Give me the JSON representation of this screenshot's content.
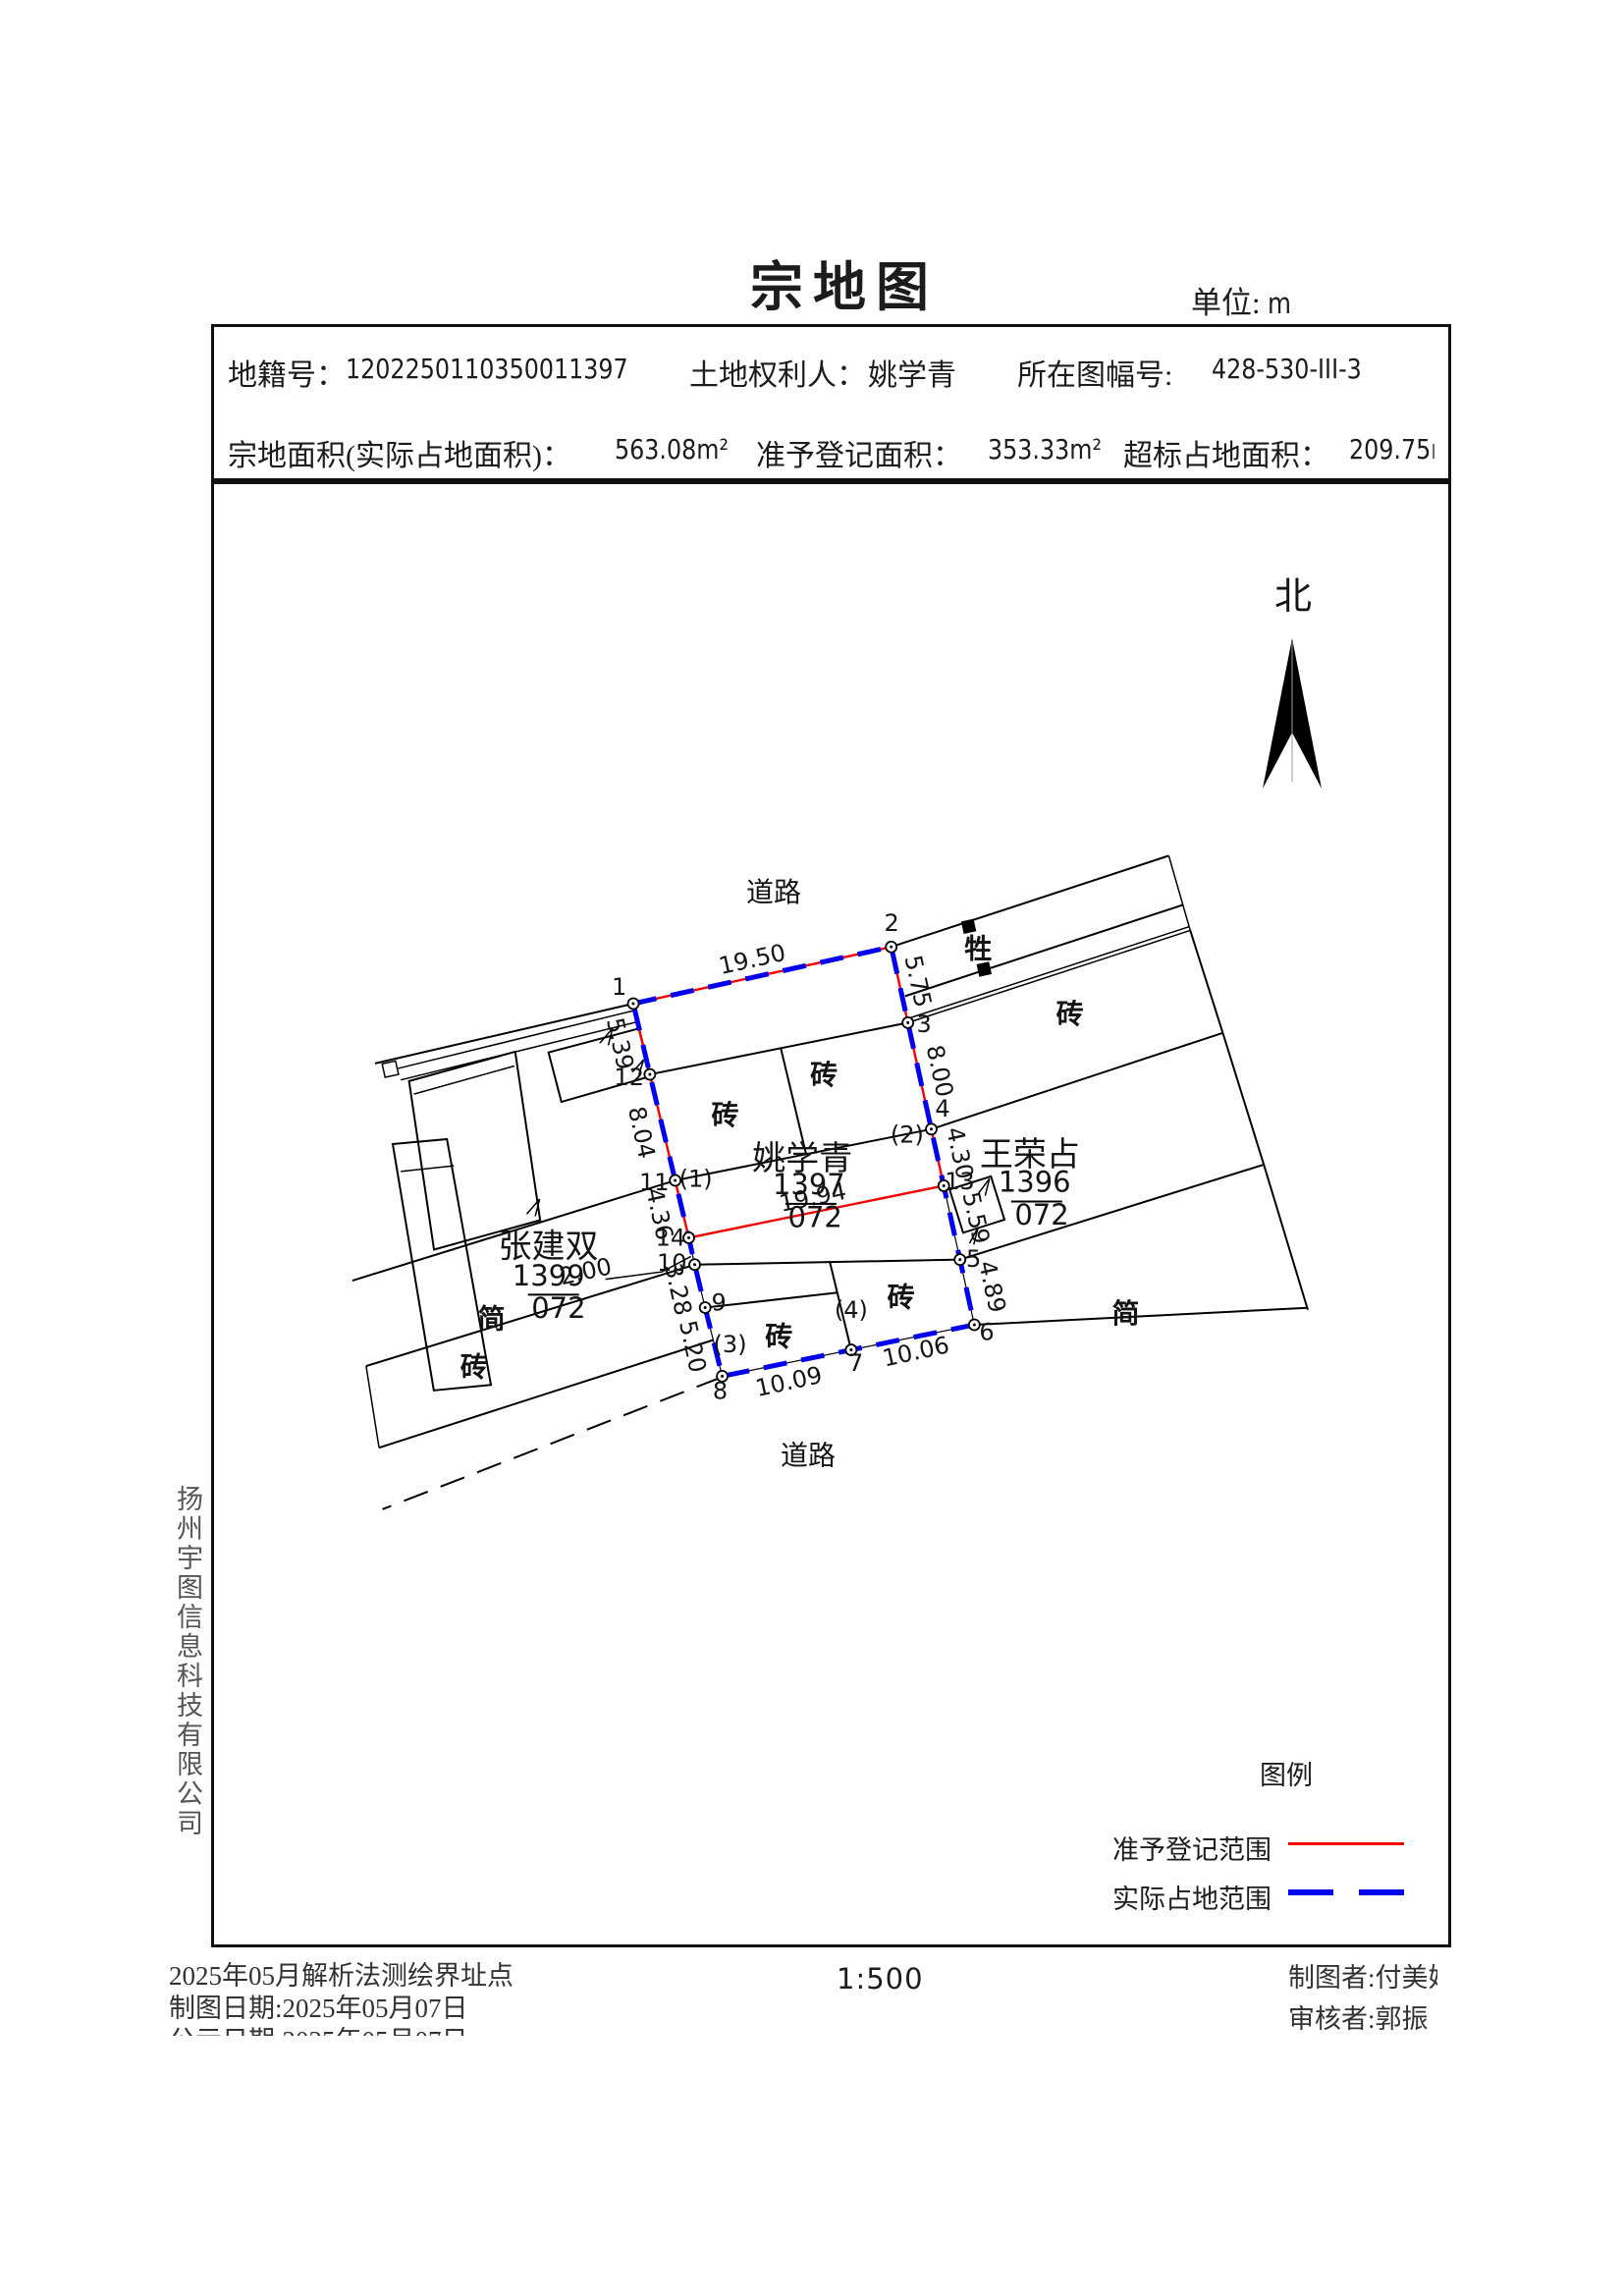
{
  "title": "宗地图",
  "unit": {
    "label": "单位:",
    "value": "m"
  },
  "header": {
    "parcel_no_label": "地籍号：",
    "parcel_no": "1202250110350011397",
    "owner_label": "土地权利人：",
    "owner": "姚学青",
    "sheet_label": "所在图幅号:",
    "sheet_no": "428-530-III-3",
    "area_label": "宗地面积(实际占地面积)：",
    "area": "563.08m²",
    "registered_label": "准予登记面积：",
    "registered": "353.33m²",
    "excess_label": "超标占地面积：",
    "excess": "209.75m"
  },
  "north_label": "北",
  "map": {
    "roads": {
      "top": "道路",
      "bottom": "道路"
    },
    "parcels": {
      "main": {
        "name": "姚学青",
        "number": "1397",
        "code": "072"
      },
      "right": {
        "name": "王荣占",
        "number": "1396",
        "code": "072"
      },
      "left": {
        "name": "张建双",
        "number": "1399",
        "code": "072"
      }
    },
    "blabels": {
      "z1": "砖",
      "z2": "砖",
      "z3": "砖",
      "z4": "砖",
      "z5": "砖",
      "z6": "砖",
      "j1": "简",
      "j2": "简",
      "s1": "牲"
    },
    "points": [
      "1",
      "2",
      "3",
      "4",
      "5",
      "6",
      "7",
      "8",
      "9",
      "10",
      "11",
      "12",
      "13",
      "14"
    ],
    "paren": [
      "(1)",
      "(2)",
      "(3)",
      "(4)"
    ],
    "dims": {
      "top": "19.50",
      "r1": "5.75",
      "r2": "8.00",
      "r3": "4.30",
      "r4": "5.59",
      "r5": "4.89",
      "b1": "10.09",
      "b2": "10.06",
      "l1": "5.39",
      "l2": "8.04",
      "l3": "4.36",
      "l4": "3.28",
      "l5": "5.20",
      "inner": "2.00",
      "red": "19.94"
    }
  },
  "legend": {
    "title": "图例",
    "items": [
      {
        "label": "准予登记范围",
        "color": "#ff0000",
        "style": "solid"
      },
      {
        "label": "实际占地范围",
        "color": "#0000ee",
        "style": "dashed"
      }
    ]
  },
  "scale": "1:500",
  "footer": {
    "line1": "2025年05月解析法测绘界址点",
    "line2": "制图日期:2025年05月07日",
    "line3": "公示日期:2025年05月07日",
    "drafter": "制图者:付美娟",
    "reviewer": "审核者:郭振"
  },
  "company": "扬州宇图信息科技有限公司",
  "colors": {
    "registered": "#ff0000",
    "actual": "#0000ee",
    "ink": "#141414"
  }
}
